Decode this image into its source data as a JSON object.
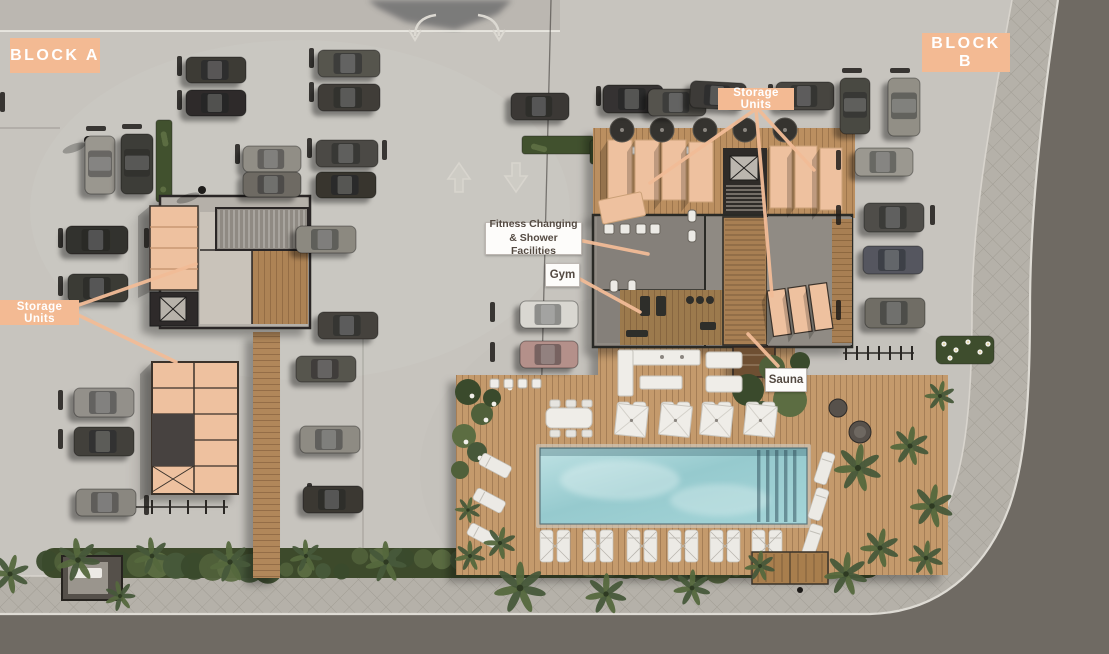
{
  "title": "Residential development site plan - aerial view",
  "labels": {
    "block_a": {
      "text": "BLOCK A"
    },
    "block_b": {
      "text": "BLOCK B"
    },
    "storage_top": {
      "text": "Storage Units",
      "leaders": [
        [
          756,
          109,
          650,
          183
        ],
        [
          756,
          109,
          772,
          296
        ],
        [
          758,
          109,
          814,
          170
        ]
      ]
    },
    "storage_left": {
      "text": "Storage Units",
      "leaders": [
        [
          76,
          306,
          196,
          264
        ],
        [
          76,
          314,
          176,
          362
        ]
      ]
    },
    "fitness": {
      "line1": "Fitness Changing",
      "line2": "& Shower Facilities",
      "leaders": [
        [
          578,
          240,
          648,
          254
        ]
      ]
    },
    "gym": {
      "text": "Gym",
      "leaders": [
        [
          578,
          278,
          640,
          312
        ]
      ]
    },
    "sauna": {
      "text": "Sauna",
      "leaders": [
        [
          778,
          366,
          748,
          334
        ]
      ]
    }
  },
  "colors": {
    "peach_label": "#f3ba93",
    "leader_line": "#f2bc97",
    "white_label_bg": "#fdfcfa",
    "white_label_text": "#544a42",
    "concrete": "#c7c4be",
    "asphalt": "#6f6a63",
    "sidewalk": "#b5b1a9",
    "deck_wood": "#c49a6c",
    "upper_deck_wood": "#bb8f61",
    "boardwalk_wood": "#b1875a",
    "storage_unit_peach": "#eec19f",
    "pool_water": "#96cace",
    "greenery": "#44522f"
  },
  "scene": {
    "cars": [
      [
        186,
        57,
        60,
        26,
        0,
        "#3c3a36"
      ],
      [
        318,
        50,
        62,
        27,
        0,
        "#56544e"
      ],
      [
        186,
        90,
        60,
        26,
        0,
        "#2e2c29"
      ],
      [
        318,
        84,
        62,
        27,
        0,
        "#403e39"
      ],
      [
        243,
        146,
        58,
        26,
        0,
        "#918e86"
      ],
      [
        316,
        140,
        62,
        27,
        0,
        "#4b4944"
      ],
      [
        243,
        172,
        58,
        25,
        0,
        "#6e6b64"
      ],
      [
        316,
        172,
        60,
        26,
        0,
        "#38362f"
      ],
      [
        296,
        226,
        60,
        27,
        0,
        "#8c8980"
      ],
      [
        85,
        136,
        30,
        58,
        0,
        "#9a978f"
      ],
      [
        121,
        134,
        32,
        60,
        0,
        "#3e3c37"
      ],
      [
        66,
        226,
        62,
        28,
        0,
        "#33312d"
      ],
      [
        68,
        274,
        60,
        28,
        0,
        "#3b3a35"
      ],
      [
        74,
        388,
        60,
        29,
        0,
        "#93908a"
      ],
      [
        74,
        427,
        60,
        29,
        0,
        "#42403b"
      ],
      [
        76,
        489,
        60,
        27,
        0,
        "#8a8780"
      ],
      [
        318,
        312,
        60,
        27,
        0,
        "#45433e"
      ],
      [
        296,
        356,
        60,
        26,
        0,
        "#57544e"
      ],
      [
        300,
        426,
        60,
        27,
        0,
        "#8e8b83"
      ],
      [
        303,
        486,
        60,
        27,
        0,
        "#3a3833"
      ],
      [
        511,
        93,
        58,
        27,
        0,
        "#3b3935"
      ],
      [
        603,
        85,
        60,
        28,
        0,
        "#343230"
      ],
      [
        648,
        89,
        58,
        27,
        0,
        "#55534d"
      ],
      [
        690,
        82,
        56,
        27,
        3,
        "#3d3b37"
      ],
      [
        776,
        82,
        58,
        28,
        0,
        "#46443f"
      ],
      [
        840,
        78,
        30,
        56,
        0,
        "#4a4842"
      ],
      [
        888,
        78,
        32,
        58,
        0,
        "#928f86"
      ],
      [
        855,
        148,
        58,
        28,
        0,
        "#9b9890"
      ],
      [
        864,
        203,
        60,
        29,
        0,
        "#4f4d48"
      ],
      [
        863,
        246,
        60,
        28,
        0,
        "#55575f"
      ],
      [
        865,
        298,
        60,
        30,
        0,
        "#6f6d65"
      ],
      [
        520,
        301,
        58,
        27,
        0,
        "#d9d7d1"
      ],
      [
        520,
        341,
        58,
        27,
        0,
        "#b4908a"
      ]
    ],
    "wheel_stops": [
      [
        177,
        56,
        0
      ],
      [
        177,
        90,
        0
      ],
      [
        309,
        48,
        0
      ],
      [
        309,
        82,
        0
      ],
      [
        235,
        144,
        0
      ],
      [
        307,
        138,
        0
      ],
      [
        58,
        228,
        0
      ],
      [
        58,
        276,
        0
      ],
      [
        58,
        390,
        0
      ],
      [
        58,
        429,
        0
      ],
      [
        144,
        228,
        0
      ],
      [
        382,
        140,
        0
      ],
      [
        490,
        302,
        0
      ],
      [
        490,
        342,
        0
      ],
      [
        596,
        86,
        0
      ],
      [
        640,
        90,
        0
      ],
      [
        768,
        84,
        0
      ],
      [
        836,
        150,
        0
      ],
      [
        836,
        205,
        0
      ],
      [
        836,
        300,
        0
      ],
      [
        930,
        205,
        0
      ],
      [
        0,
        92,
        0
      ],
      [
        144,
        495,
        0
      ],
      [
        307,
        483,
        0
      ],
      [
        86,
        126,
        1
      ],
      [
        122,
        124,
        1
      ],
      [
        842,
        68,
        1
      ],
      [
        890,
        68,
        1
      ]
    ],
    "palms": [
      [
        78,
        560,
        20
      ],
      [
        152,
        556,
        17
      ],
      [
        230,
        562,
        19
      ],
      [
        306,
        556,
        15
      ],
      [
        386,
        562,
        19
      ],
      [
        470,
        556,
        14
      ],
      [
        520,
        588,
        24
      ],
      [
        606,
        594,
        19
      ],
      [
        692,
        588,
        17
      ],
      [
        760,
        566,
        14
      ],
      [
        846,
        574,
        20
      ],
      [
        926,
        558,
        16
      ],
      [
        858,
        468,
        22
      ],
      [
        910,
        446,
        18
      ],
      [
        932,
        506,
        20
      ],
      [
        880,
        548,
        18
      ],
      [
        940,
        396,
        14
      ],
      [
        500,
        543,
        15
      ],
      [
        468,
        510,
        12
      ],
      [
        10,
        574,
        18
      ],
      [
        120,
        596,
        14
      ]
    ],
    "hedges": [
      [
        156,
        120,
        16,
        82
      ],
      [
        522,
        136,
        72,
        18
      ],
      [
        590,
        140,
        12,
        24
      ]
    ],
    "umbrella_sets_cx": [
      632,
      676,
      717,
      761
    ],
    "lounger_pairs_cx": [
      555,
      598,
      642,
      683,
      725,
      767
    ],
    "left_loungers": [
      [
        489,
        450
      ],
      [
        483,
        485
      ],
      [
        477,
        520
      ]
    ],
    "right_loungers": [
      [
        818,
        452
      ],
      [
        812,
        488
      ],
      [
        806,
        524
      ]
    ],
    "parasols": [
      [
        622,
        130
      ],
      [
        662,
        130
      ],
      [
        705,
        130
      ],
      [
        745,
        130
      ],
      [
        785,
        130
      ]
    ],
    "planters": [
      612,
      630,
      648,
      666,
      684
    ]
  }
}
